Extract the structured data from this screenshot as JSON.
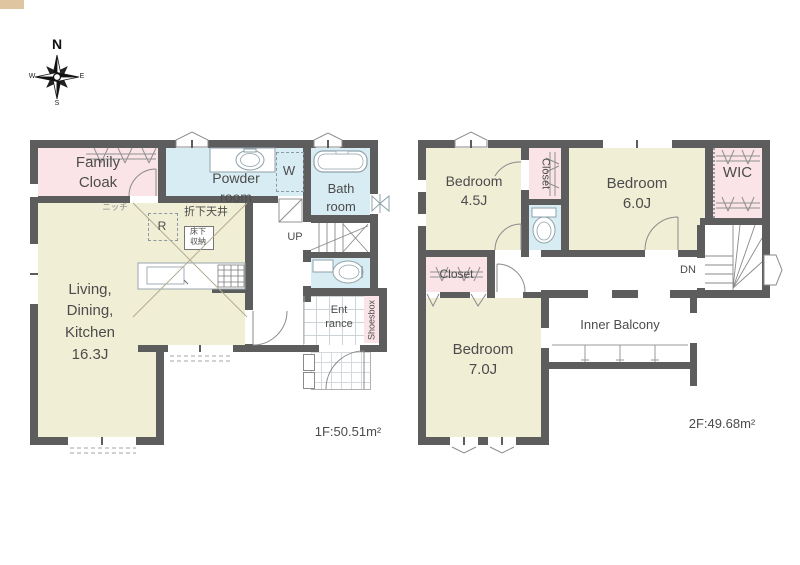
{
  "compass": {
    "north": "N",
    "east": "E",
    "south": "S",
    "west": "W"
  },
  "palette": {
    "wall": "#5d5d5d",
    "room_yellow": "#f1eed6",
    "room_pink": "#fbe4e8",
    "room_blue": "#d8ecf3",
    "niche_tan": "#dfc5a0",
    "line_gray": "#8a8a8a",
    "fixture_line": "#8fa2aa",
    "text": "#4c4c4c"
  },
  "floor1": {
    "area_label": "1F:50.51m²",
    "rooms": {
      "family_cloak": "Family\nCloak",
      "powder_room": "Powder\nroom",
      "washer": "W",
      "bath_room": "Bath\nroom",
      "ldk": "Living,\nDining,\nKitchen\n16.3J",
      "dropped_ceiling": "折下天井",
      "refrigerator": "R",
      "underfloor_storage": "床下\n収納",
      "niche": "ニッチ",
      "stairs_up": "UP",
      "entrance": "Ent\nrance",
      "shoesbox": "Shoesbox"
    }
  },
  "floor2": {
    "area_label": "2F:49.68m²",
    "rooms": {
      "bedroom_45": "Bedroom\n4.5J",
      "closet_north": "Closet",
      "bedroom_60": "Bedroom\n6.0J",
      "wic": "WIC",
      "closet_west": "Closet",
      "bedroom_70": "Bedroom\n7.0J",
      "inner_balcony": "Inner Balcony",
      "stairs_down": "DN"
    }
  }
}
